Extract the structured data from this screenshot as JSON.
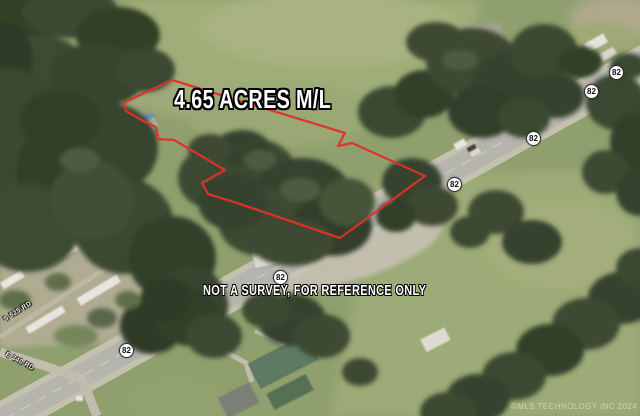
{
  "overlay": {
    "acreage_label": "4.65 ACRES M/L",
    "disclaimer": "NOT A SURVEY, FOR REFERENCE ONLY",
    "watermark": "©MLS TECHNOLOGY INC 2024",
    "parcel_outline": {
      "color": "#e03127",
      "points": "172,80 345,133 338,146 352,143 425,176 340,238 237,203 208,194 202,183 225,170 174,140 158,139 156,127 143,121 126,111 123,103"
    }
  },
  "map": {
    "highway": {
      "route": "82"
    },
    "road_labels": [
      {
        "name": "S 525 RD"
      },
      {
        "name": "E 340 RD"
      }
    ]
  }
}
